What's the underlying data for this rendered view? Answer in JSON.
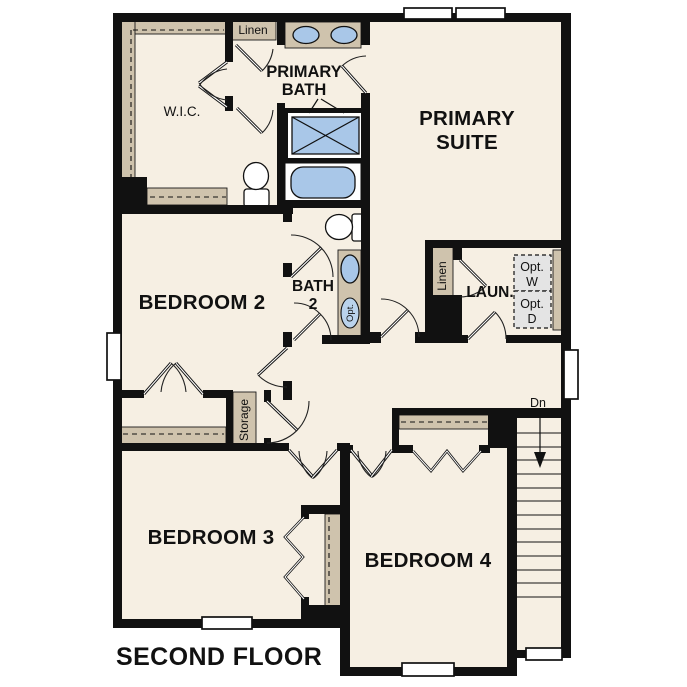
{
  "palette": {
    "background": "#ffffff",
    "floor": "#f6efe3",
    "shelf_tan": "#cfc3ad",
    "fixture_blue": "#a9c7e8",
    "optional_fixture_blue": "#bad3ec",
    "wall_black": "#111111",
    "appliance_gray": "#e4e4e4"
  },
  "plan": {
    "floor_name": "SECOND FLOOR",
    "rooms": {
      "primary_suite": {
        "line1": "PRIMARY",
        "line2": "SUITE"
      },
      "primary_bath": {
        "line1": "PRIMARY",
        "line2": "BATH"
      },
      "wic": {
        "label": "W.I.C."
      },
      "linen_top": {
        "label": "Linen"
      },
      "bedroom2": {
        "label": "BEDROOM 2"
      },
      "bath2": {
        "line1": "BATH",
        "line2": "2"
      },
      "laundry": {
        "label": "LAUN."
      },
      "linen_laundry": {
        "label": "Linen"
      },
      "storage": {
        "label": "Storage"
      },
      "bedroom3": {
        "label": "BEDROOM 3"
      },
      "bedroom4": {
        "label": "BEDROOM 4"
      }
    },
    "fixtures": {
      "optional_washer": {
        "line1": "Opt.",
        "line2": "W"
      },
      "optional_dryer": {
        "line1": "Opt.",
        "line2": "D"
      },
      "optional_sink": {
        "label": "Opt."
      }
    },
    "stairs": {
      "direction_label": "Dn"
    }
  }
}
